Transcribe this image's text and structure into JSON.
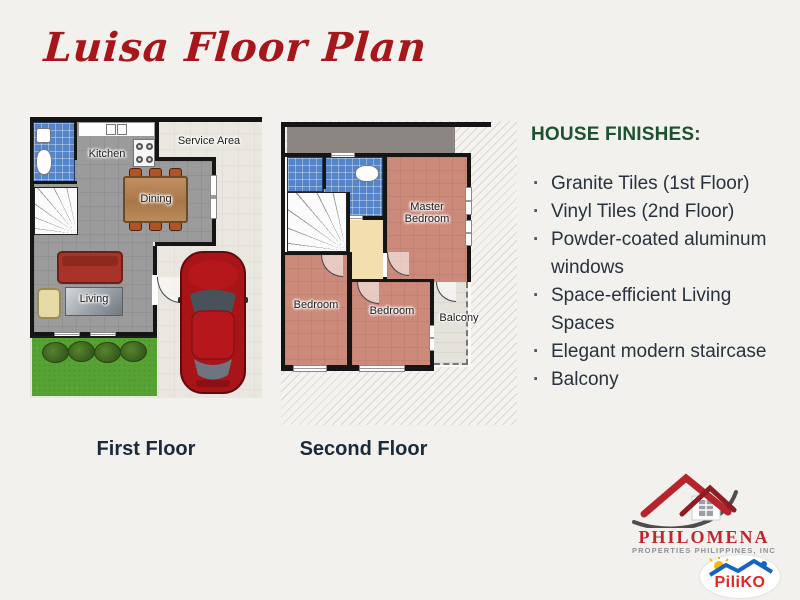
{
  "title": "Luisa Floor Plan",
  "plans": {
    "first": {
      "caption": "First Floor",
      "rooms": {
        "kitchen": "Kitchen",
        "service_area": "Service Area",
        "dining": "Dining",
        "living": "Living"
      }
    },
    "second": {
      "caption": "Second Floor",
      "rooms": {
        "master_bedroom": "Master Bedroom",
        "bedroom_left": "Bedroom",
        "bedroom_middle": "Bedroom",
        "balcony": "Balcony"
      }
    }
  },
  "finishes": {
    "heading": "HOUSE FINISHES:",
    "items": [
      "Granite Tiles (1st Floor)",
      "Vinyl Tiles (2nd Floor)",
      "Powder-coated aluminum windows",
      "Space-efficient Living Spaces",
      "Elegant modern staircase",
      "Balcony"
    ]
  },
  "branding": {
    "company": "PHILOMENA",
    "company_subtitle": "PROPERTIES PHILIPPINES, INC",
    "marketplace": "PiliKO"
  },
  "colors": {
    "title_red": "#a6171c",
    "heading_green": "#1d5130",
    "body_text": "#28323e",
    "brand_red": "#c0272c",
    "piliko_red": "#e02720",
    "piliko_blue": "#1565c0",
    "floor_gray": "#9b9b9b",
    "bathroom_blue": "#5585c8",
    "bedroom_salmon": "#cc8a7a",
    "lawn_green": "#56a233",
    "wall_black": "#151515"
  }
}
